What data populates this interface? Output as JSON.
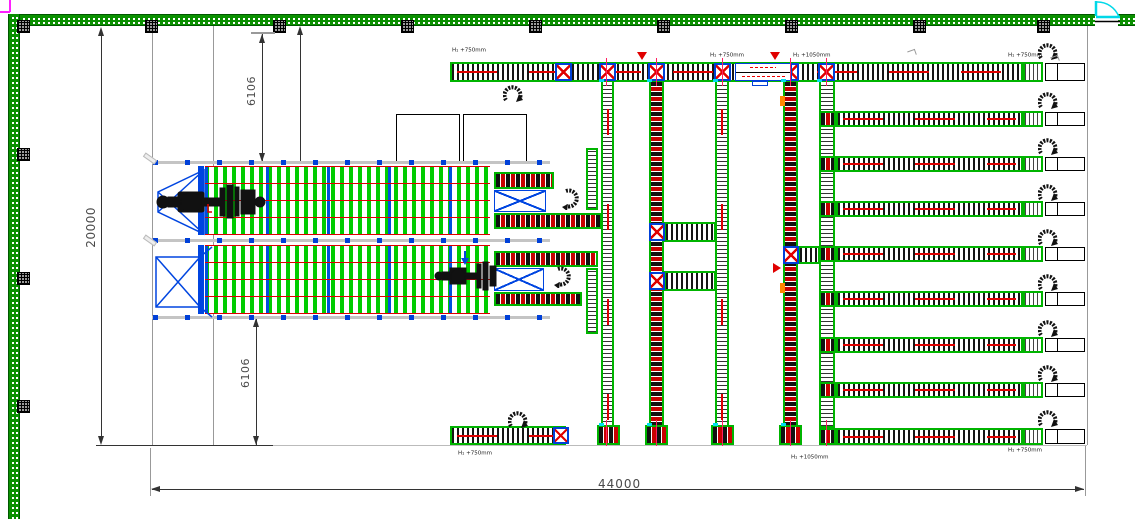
{
  "drawing": {
    "type": "warehouse-conveyor-layout-plan",
    "dimensions": {
      "overall_width": "44000",
      "overall_height": "20000",
      "offset_top": "6106",
      "offset_bottom": "6106"
    },
    "height_labels": {
      "h750": "H₁ +750mm",
      "h1050": "H₁ +1050mm"
    },
    "icons": {
      "rotation_arrow": "↻",
      "level_marker_down": "▽",
      "flow_marker_right": "▷",
      "door_swing": "quarter-arc"
    },
    "colors": {
      "wall_green": "#0a9000",
      "conveyor_border_green": "#00b400",
      "rack_slat_green": "#00cc00",
      "beam_red": "#e00000",
      "frame_blue": "#0045e0",
      "door_cyan": "#00d8e8",
      "viewport_magenta": "#ff20ff",
      "marker_orange": "#ff8800",
      "dimension_gray": "#4a4a4a"
    }
  }
}
